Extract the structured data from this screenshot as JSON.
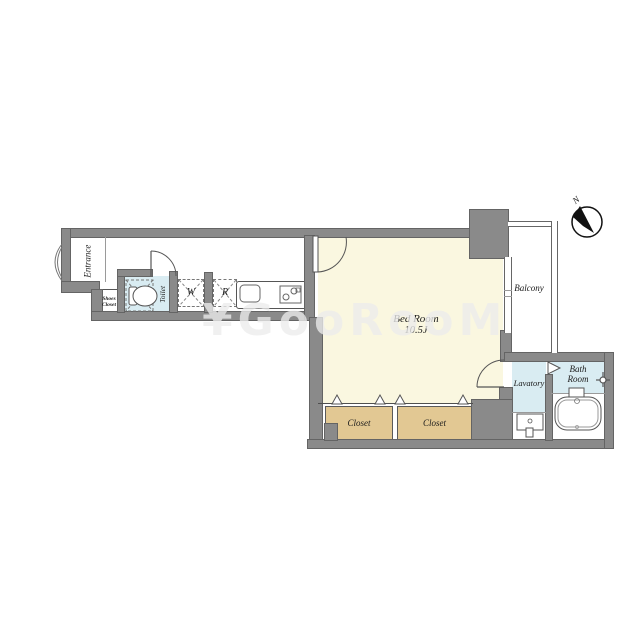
{
  "watermark": {
    "text": "¥GooRooM"
  },
  "compass": {
    "label": "N"
  },
  "rooms": {
    "entrance": {
      "label": "Entrance"
    },
    "shoes_closet": {
      "label": "Shoes Closet"
    },
    "toilet": {
      "label": "Toilet"
    },
    "washing_machine": {
      "label": "W"
    },
    "refrigerator": {
      "label": "R"
    },
    "bed_room": {
      "label": "Bed Room",
      "area": "10.5J"
    },
    "balcony": {
      "label": "Balcony"
    },
    "lavatory": {
      "label": "Lavatory"
    },
    "bath_room": {
      "label": "Bath Room"
    },
    "closet_left": {
      "label": "Closet"
    },
    "closet_right": {
      "label": "Closet"
    }
  },
  "colors": {
    "wall_fill": "#8a8a8a",
    "wall_outline": "#646464",
    "bedroom_fill": "#faf7e0",
    "wet_area_fill": "#d9ecf2",
    "closet_fill": "#e2c893",
    "floor_fill": "#ffffff",
    "line": "#555555",
    "watermark_color": "rgba(236,236,236,0.78)"
  }
}
